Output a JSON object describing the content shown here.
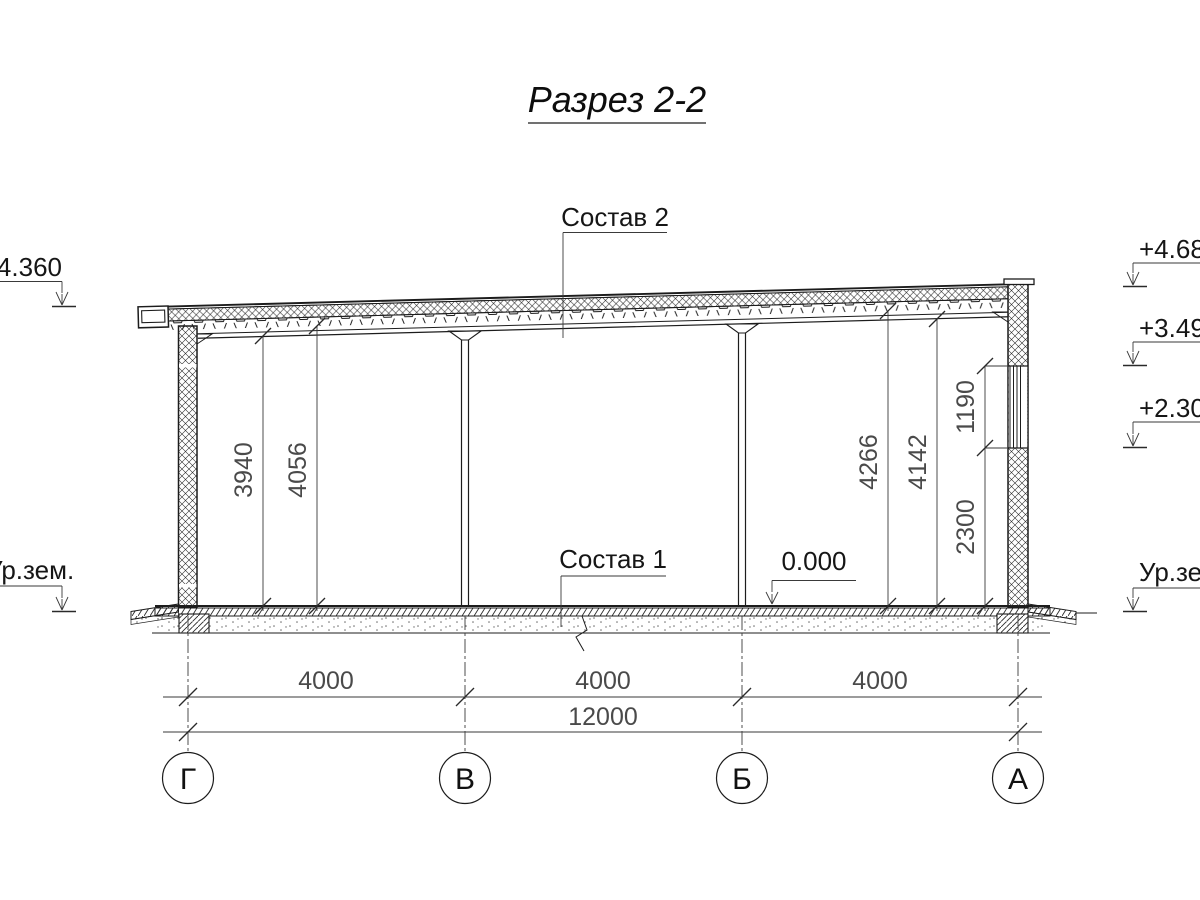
{
  "title": "Разрез 2-2",
  "callouts": {
    "roof": "Состав 2",
    "floor": "Состав 1",
    "zero_level": "0.000"
  },
  "elevation_marks": {
    "left": [
      {
        "label": "+4.360"
      },
      {
        "label": "Ур.зем."
      }
    ],
    "right": [
      {
        "label": "+4.68"
      },
      {
        "label": "+3.49"
      },
      {
        "label": "+2.30"
      },
      {
        "label": "Ур.зем."
      }
    ]
  },
  "dimensions": {
    "vertical_left": [
      "3940",
      "4056"
    ],
    "vertical_right": [
      "4266",
      "4142",
      "1190",
      "2300"
    ],
    "bays": [
      "4000",
      "4000",
      "4000"
    ],
    "total": "12000"
  },
  "axes": [
    "Г",
    "В",
    "Б",
    "А"
  ]
}
